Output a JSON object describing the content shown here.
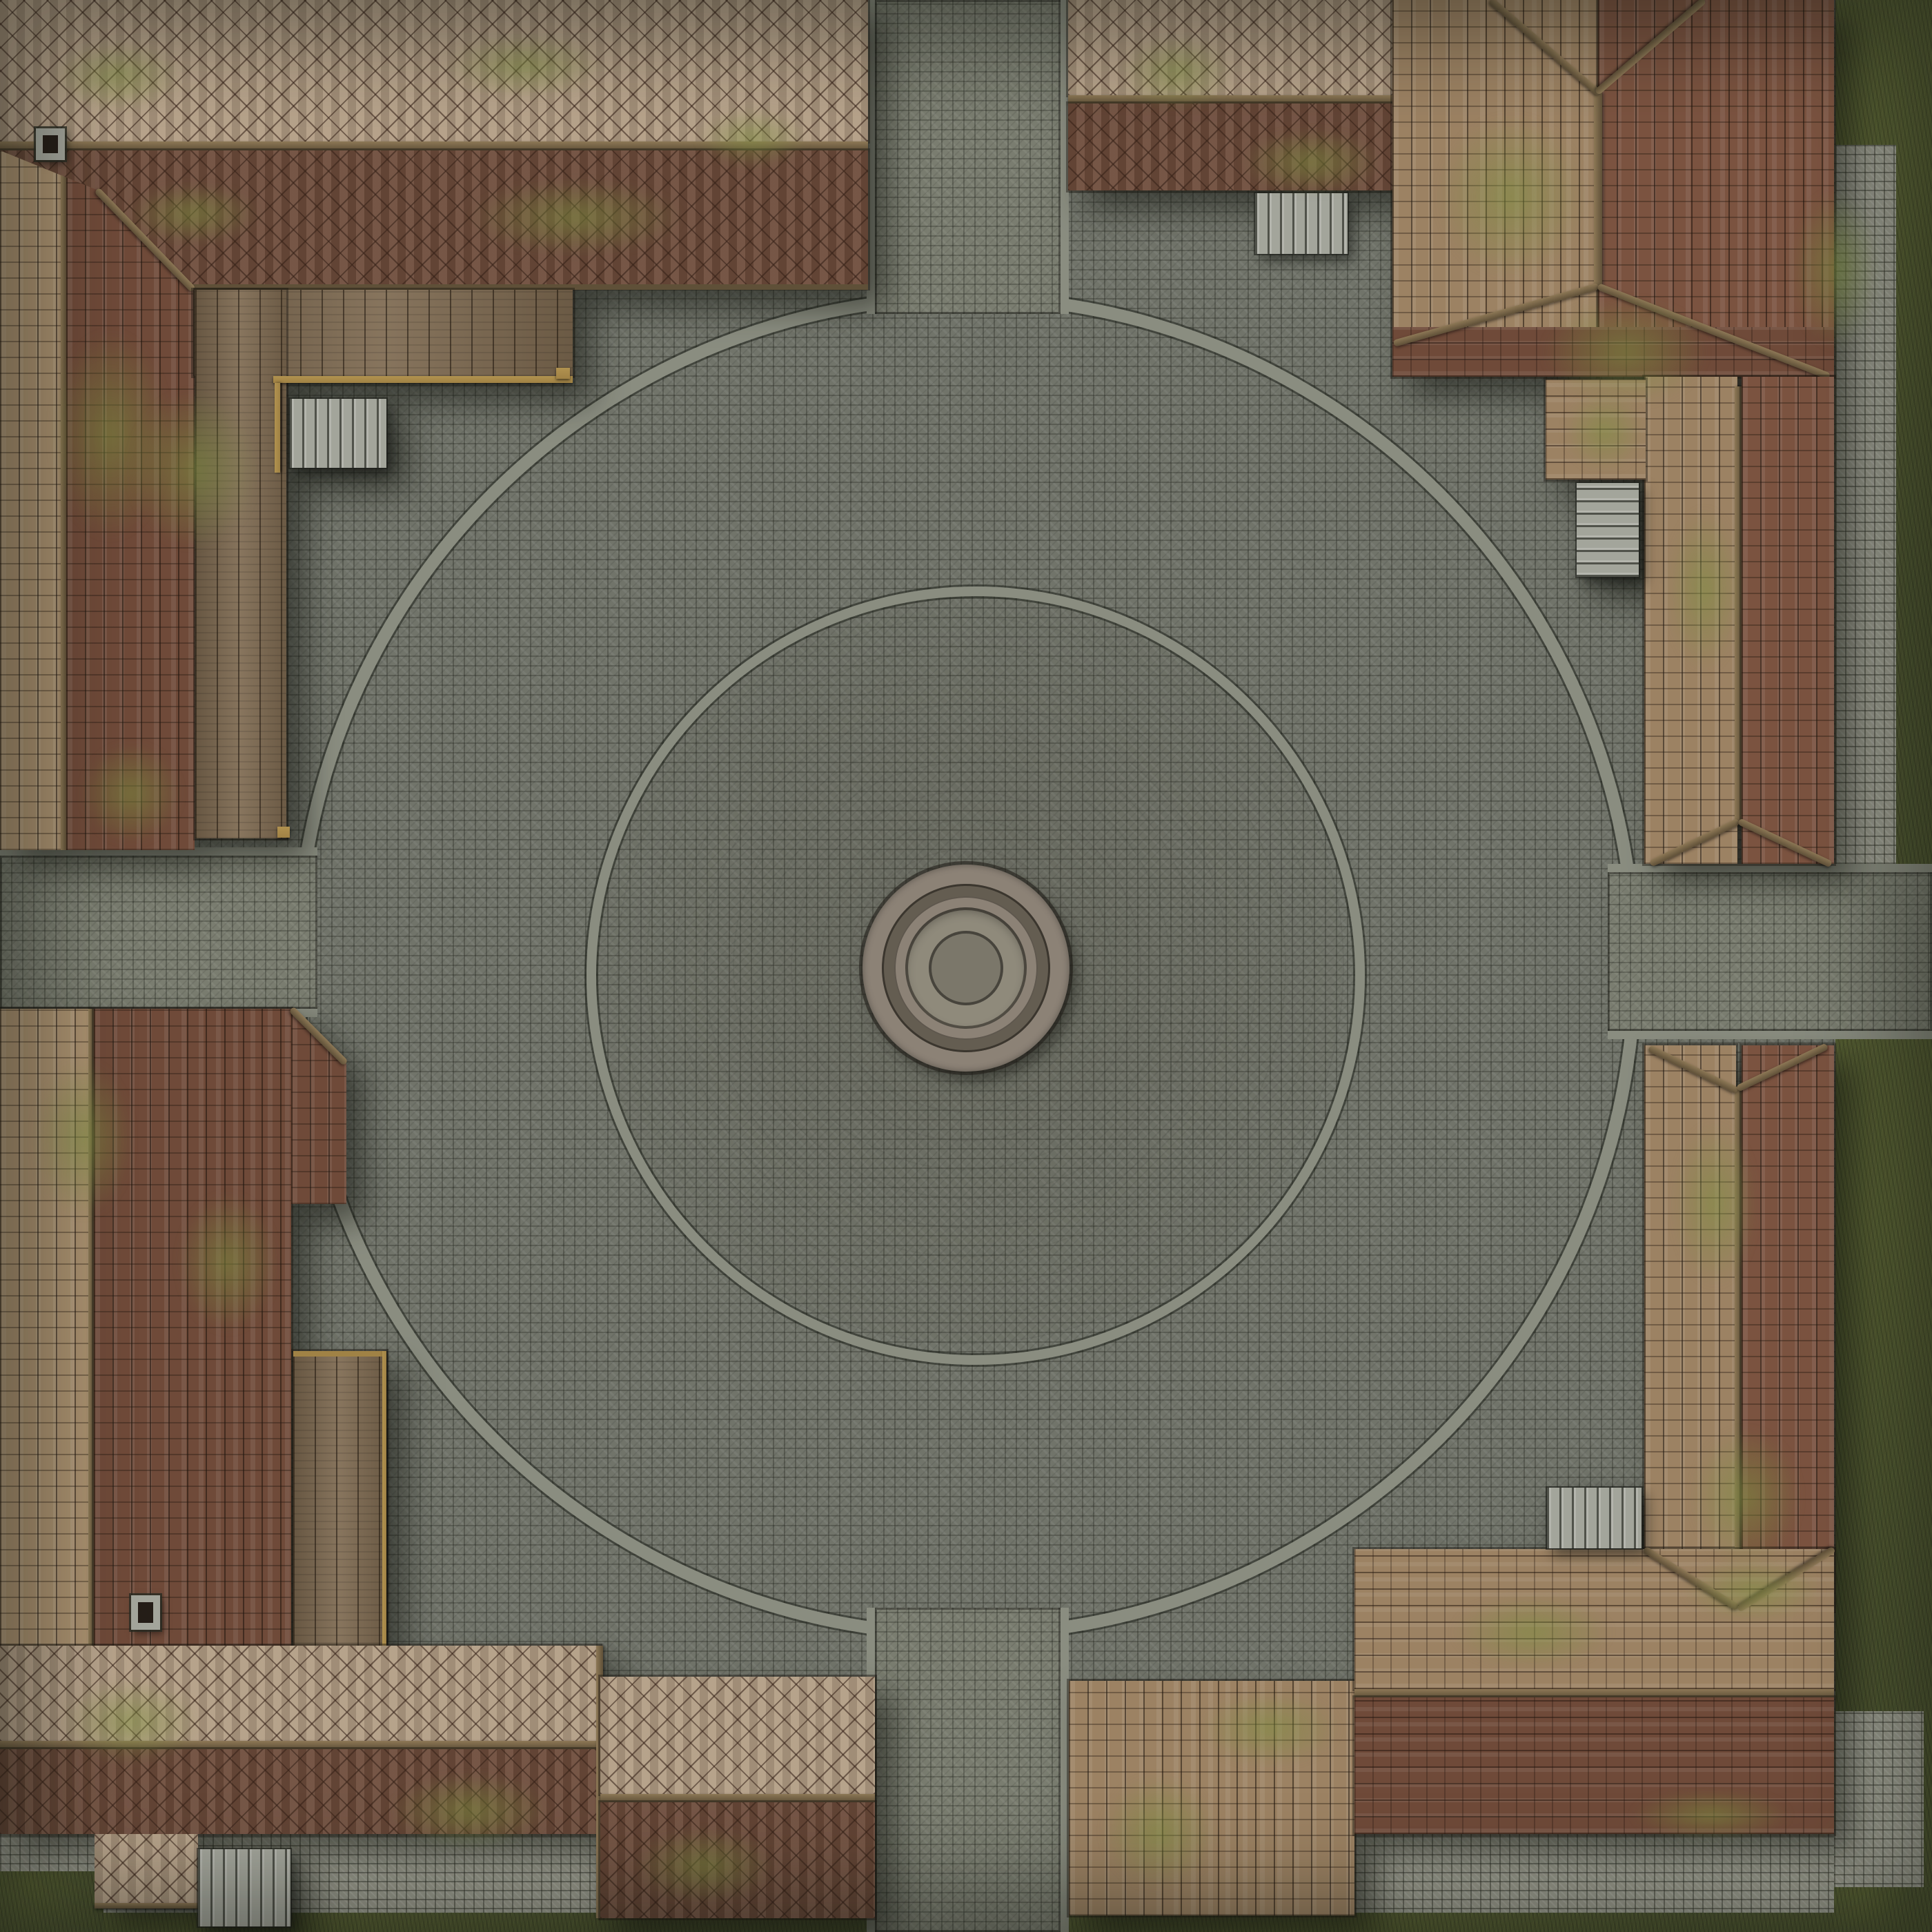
{
  "title": "Village Plaza Courtyard Battlemap (top-down)",
  "scene": {
    "type": "top-down fantasy battlemap",
    "setting": "cobblestone village plaza enclosed by four shingle-roofed buildings",
    "features": [
      "central-circular-fountain",
      "inner-stone-ring",
      "outer-stone-ring",
      "north-road",
      "east-road",
      "south-road",
      "west-road",
      "northwest-building",
      "northeast-building",
      "southeast-building",
      "southwest-building",
      "wooden-deck-and-walkways",
      "five-stone-staircases",
      "two-stone-chimneys",
      "moss-patches-on-roofs",
      "grass-verges-east-and-south",
      "rubble-stone-borders"
    ]
  },
  "palette": {
    "cobble": "#71746a",
    "road": "#7a7d70",
    "curb": "#8a8d80",
    "rubble": "#9a9b8e",
    "grass": "#4c5430",
    "grass-light": "#5e6737",
    "dirt": "#45412f",
    "roof-light": "#b29d84",
    "roof-dark": "#6d4c3b",
    "strip-light": "#a9906f",
    "strip-tan": "#9c8263",
    "strip-dark": "#6f4a39",
    "strip-red": "#7b5340",
    "moss": "#7e8e4b",
    "wood": "#7e6a51",
    "beam": "#8d7856",
    "beam-dark": "#5f5038",
    "trim": "#a08245",
    "stair": "#a3a59b",
    "fountain-rim": "#8c8276",
    "fountain-groove": "#645d51",
    "fountain-basin": "#8f8a7b",
    "fountain-core": "#7b776a",
    "ink": "#241d17"
  }
}
